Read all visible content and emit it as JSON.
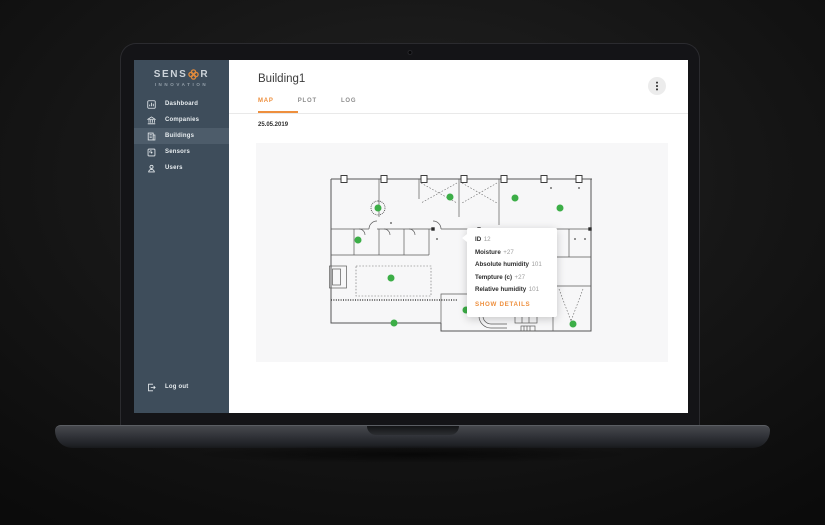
{
  "app": {
    "logo": {
      "text_left": "SENS",
      "text_right": "R",
      "subtitle": "INNOVATION"
    },
    "sidebar": {
      "items": [
        {
          "label": "Dashboard",
          "icon": "dashboard-icon",
          "active": false
        },
        {
          "label": "Companies",
          "icon": "bank-icon",
          "active": false
        },
        {
          "label": "Buildings",
          "icon": "building-icon",
          "active": true
        },
        {
          "label": "Sensors",
          "icon": "sensor-icon",
          "active": false
        },
        {
          "label": "Users",
          "icon": "user-icon",
          "active": false
        }
      ],
      "logout_label": "Log out"
    },
    "header": {
      "title": "Building1",
      "menu_icon": "kebab-menu-icon"
    },
    "tabs": [
      {
        "label": "MAP",
        "active": true
      },
      {
        "label": "PLOT",
        "active": false
      },
      {
        "label": "LOG",
        "active": false
      }
    ],
    "date": "25.05.2019",
    "map": {
      "markers": [
        {
          "x": 49,
          "y": 35,
          "selected": true
        },
        {
          "x": 121,
          "y": 24,
          "selected": false
        },
        {
          "x": 186,
          "y": 25,
          "selected": false
        },
        {
          "x": 231,
          "y": 35,
          "selected": false
        },
        {
          "x": 29,
          "y": 67,
          "selected": false
        },
        {
          "x": 62,
          "y": 105,
          "selected": false
        },
        {
          "x": 137,
          "y": 137,
          "selected": false
        },
        {
          "x": 65,
          "y": 150,
          "selected": false
        },
        {
          "x": 244,
          "y": 151,
          "selected": false
        }
      ],
      "tooltip": {
        "rows": [
          {
            "label": "ID",
            "value": "12"
          },
          {
            "label": "Moisture",
            "value": "+27"
          },
          {
            "label": "Absolute humidity",
            "value": "101"
          },
          {
            "label": "Tempture (c)",
            "value": "+27"
          },
          {
            "label": "Relative humidity",
            "value": "101"
          }
        ],
        "action_label": "SHOW DETAILS"
      }
    },
    "colors": {
      "accent": "#ee8f3d",
      "sidebar": "#3e4d5b",
      "sidebar_active": "#4d5c6a",
      "sensor_green": "#3cae47"
    }
  }
}
